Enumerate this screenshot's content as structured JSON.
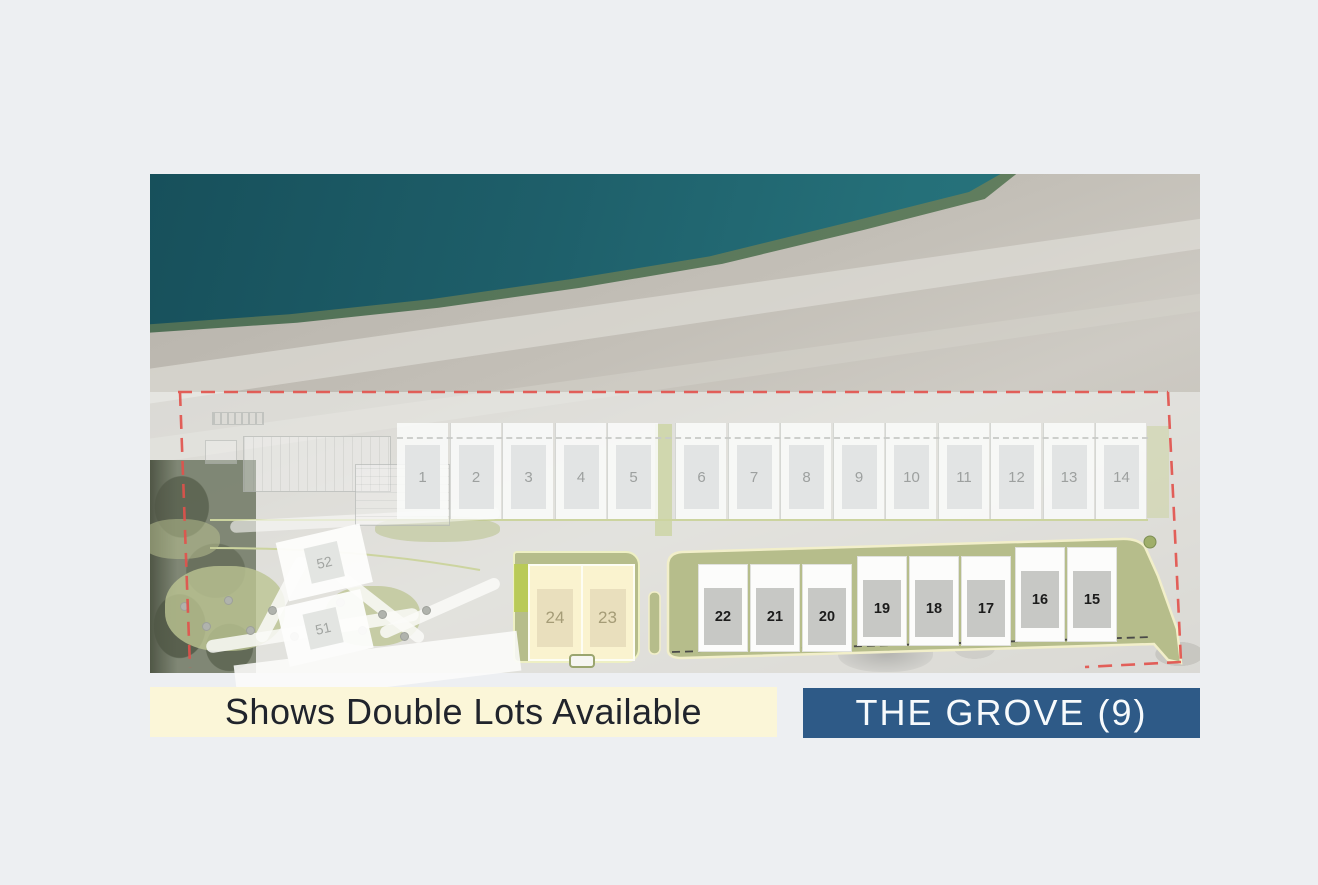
{
  "legend": {
    "double_lots_label": "Shows Double Lots Available",
    "grove_label": "THE GROVE (9)"
  },
  "site_plan": {
    "upper_lots": [
      "1",
      "2",
      "3",
      "4",
      "5",
      "6",
      "7",
      "8",
      "9",
      "10",
      "11",
      "12",
      "13",
      "14"
    ],
    "grove_lots": [
      "22",
      "21",
      "20",
      "19",
      "18",
      "17",
      "16",
      "15"
    ],
    "double_lots": [
      "24",
      "23"
    ],
    "estate_lots": [
      "52",
      "51"
    ]
  },
  "colors": {
    "page_bg": "#edeff2",
    "ocean_teal": "#1e5f6a",
    "beach_sand": "#c3bfb7",
    "grove_band_green": "#b6bd8b",
    "double_lot_yellow": "#faf3cf",
    "boundary_red": "#e2514b",
    "legend_yellow_bg": "#fbf6d8",
    "legend_blue_bg": "#2e5a87"
  }
}
